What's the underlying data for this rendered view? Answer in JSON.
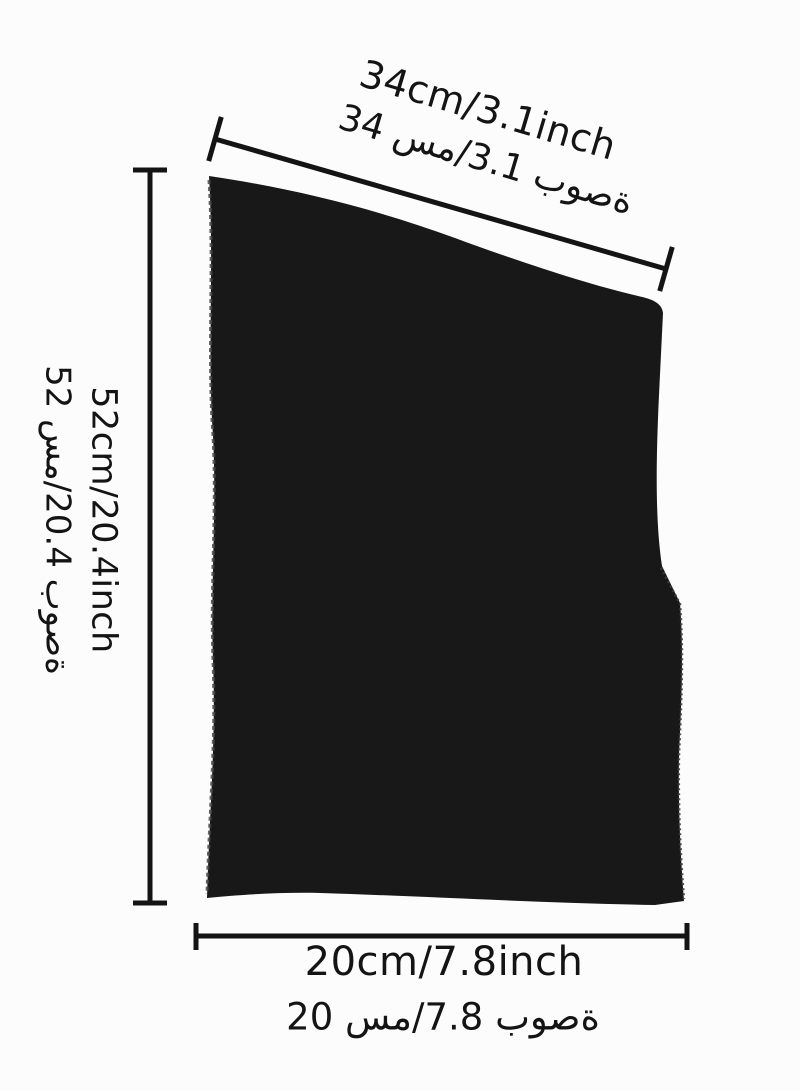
{
  "product_diagram": {
    "description_icon": "fabric-dimension-diagram",
    "top_dimension": {
      "en": "34cm/3.1inch",
      "ar": "34 سم/3.1 بوصة"
    },
    "left_dimension": {
      "en": "52cm/20.4inch",
      "ar": "52 سم/20.4 بوصة"
    },
    "bottom_dimension": {
      "en": "20cm/7.8inch",
      "ar": "20 سم/7.8 بوصة"
    },
    "colors": {
      "fabric": "#181818",
      "fabric_edge": "#474747",
      "dimension_line": "#141414",
      "background": "#fdfcfc"
    }
  }
}
